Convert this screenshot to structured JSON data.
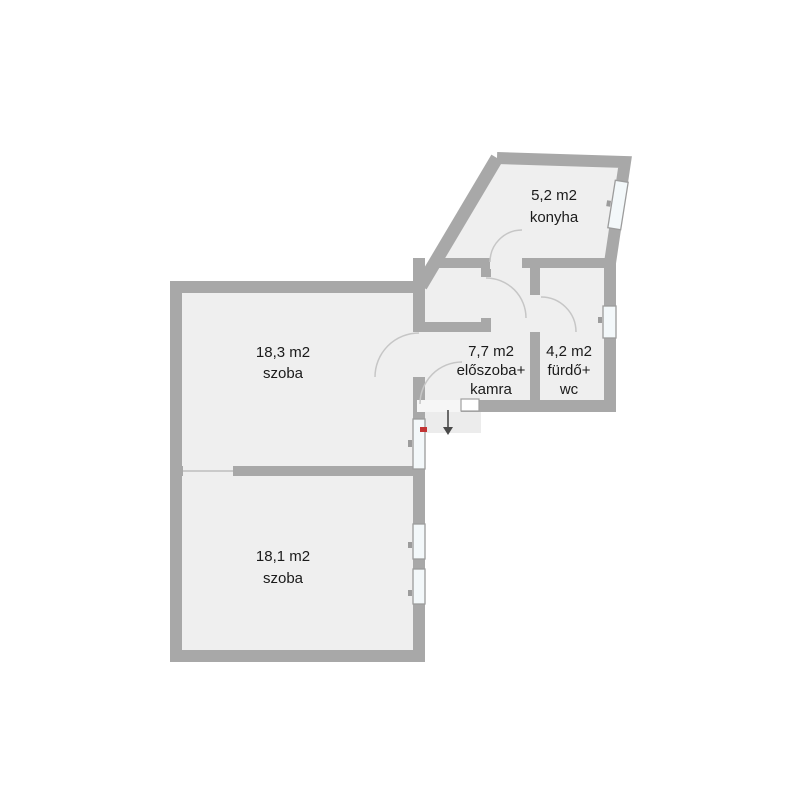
{
  "rooms": [
    {
      "id": "konyha",
      "area": "5,2 m2",
      "name": "konyha"
    },
    {
      "id": "szoba-felso",
      "area": "18,3 m2",
      "name": "szoba"
    },
    {
      "id": "eloszoba-kamra",
      "area": "7,7 m2",
      "name": "előszoba+",
      "name2": "kamra"
    },
    {
      "id": "furdo-wc",
      "area": "4,2 m2",
      "name": "fürdő+",
      "name2": "wc"
    },
    {
      "id": "szoba-also",
      "area": "18,1 m2",
      "name": "szoba"
    }
  ],
  "icons": {
    "entrance_arrow": "down-arrow marking entrance direction",
    "entrance_marker": "small red entrance marker"
  },
  "colors": {
    "background": "#ffffff",
    "wall": "#a8a8a8",
    "floor": "#efefef",
    "window": "#f3f8fa",
    "door_arc": "#c6c6c6",
    "landing": "#ececec",
    "entrance_marker": "#c23434",
    "arrow": "#4a4a4a",
    "text": "#1b1b1b"
  }
}
